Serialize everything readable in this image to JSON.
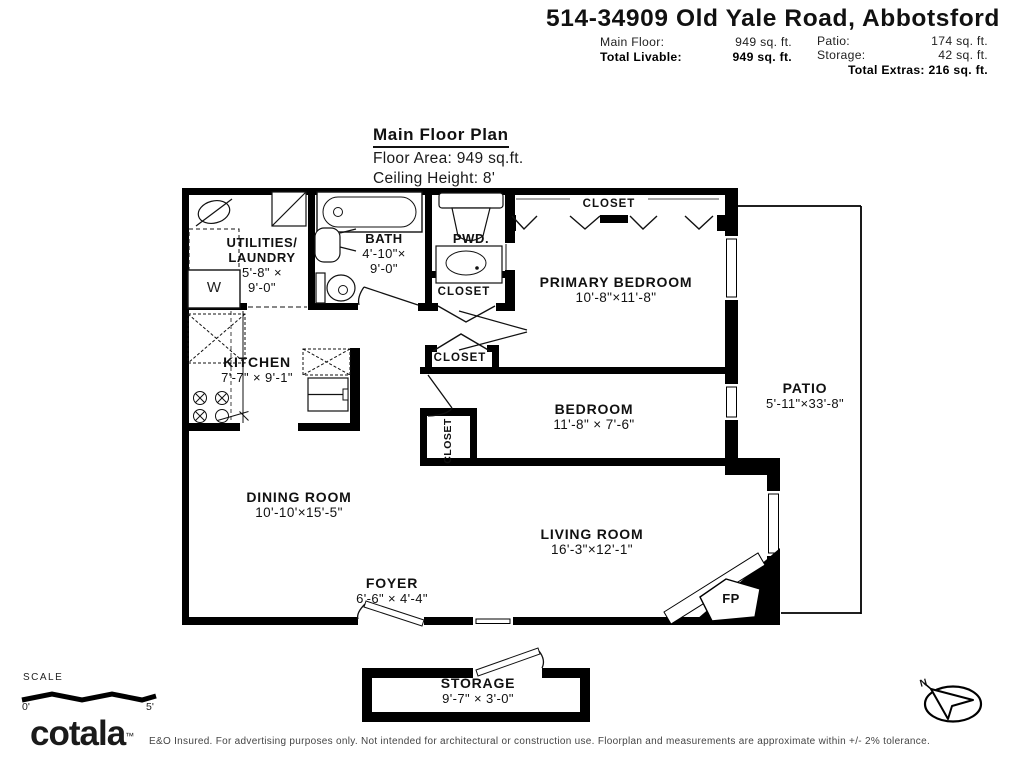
{
  "header": {
    "title": "514-34909 Old Yale Road, Abbotsford",
    "main_floor_label": "Main Floor:",
    "main_floor_value": "949 sq. ft.",
    "total_livable_label": "Total Livable:",
    "total_livable_value": "949 sq. ft.",
    "patio_label": "Patio:",
    "patio_value": "174 sq. ft.",
    "storage_label": "Storage:",
    "storage_value": "42 sq. ft.",
    "total_extras": "Total Extras: 216 sq. ft."
  },
  "plan_title": {
    "heading": "Main Floor Plan",
    "floor_area": "Floor Area: 949 sq.ft.",
    "ceiling_height": "Ceiling Height: 8'"
  },
  "rooms": {
    "utilities": {
      "name1": "UTILITIES/",
      "name2": "LAUNDRY",
      "dim1": "5'-8\" ×",
      "dim2": "9'-0\""
    },
    "bath": {
      "name": "BATH",
      "dim1": "4'-10\"×",
      "dim2": "9'-0\""
    },
    "pwd": {
      "name": "PWD."
    },
    "closet_top": {
      "name": "CLOSET"
    },
    "primary_bedroom": {
      "name": "PRIMARY BEDROOM",
      "dims": "10'-8\"×11'-8\""
    },
    "closet_hall_upper": {
      "name": "CLOSET"
    },
    "closet_hall_lower": {
      "name": "CLOSET"
    },
    "kitchen": {
      "name": "KITCHEN",
      "dims": "7'-7\" × 9'-1\""
    },
    "bedroom": {
      "name": "BEDROOM",
      "dims": "11'-8\" × 7'-6\""
    },
    "bedroom_closet": {
      "name": "CLOSET"
    },
    "patio": {
      "name": "PATIO",
      "dims": "5'-11\"×33'-8\""
    },
    "dining": {
      "name": "DINING ROOM",
      "dims": "10'-10'×15'-5\""
    },
    "living": {
      "name": "LIVING ROOM",
      "dims": "16'-3\"×12'-1\""
    },
    "foyer": {
      "name": "FOYER",
      "dims": "6'-6\" × 4'-4\""
    },
    "storage": {
      "name": "STORAGE",
      "dims": "9'-7\" × 3'-0\""
    },
    "fireplace": {
      "label": "FP"
    },
    "washer": {
      "label": "W"
    }
  },
  "scale": {
    "label": "SCALE",
    "start": "0'",
    "end": "5'"
  },
  "compass": {
    "north_label": "N"
  },
  "footer": {
    "logo": "cotala",
    "trademark": "™",
    "disclaimer": "E&O Insured. For advertising purposes only. Not intended for architectural or construction use. Floorplan and measurements are approximate within +/- 2% tolerance."
  },
  "colors": {
    "wall": "#000000",
    "background": "#ffffff",
    "text": "#111111"
  }
}
